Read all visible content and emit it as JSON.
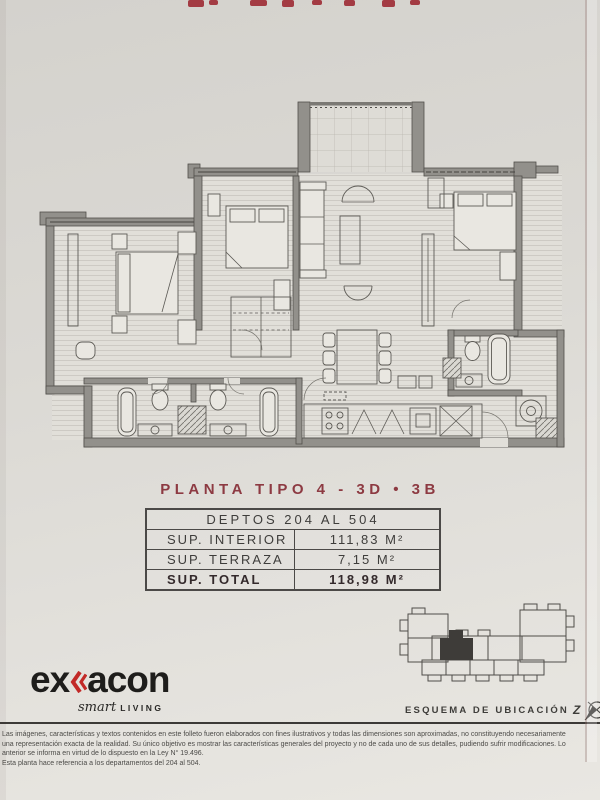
{
  "title": "PLANTA TIPO 4 - 3D • 3B",
  "table": {
    "header": "DEPTOS 204 AL 504",
    "rows": [
      {
        "label": "SUP. INTERIOR",
        "value": "111,83 M²"
      },
      {
        "label": "SUP. TERRAZA",
        "value": "7,15 M²"
      },
      {
        "label": "SUP. TOTAL",
        "value": "118,98 M²"
      }
    ]
  },
  "logo": {
    "text_before": "ex",
    "text_after": "acon",
    "tagline_script": "smart",
    "tagline_caps": "LIVING"
  },
  "location": {
    "label": "ESQUEMA DE UBICACIÓN",
    "compass_letter": "Z"
  },
  "legal": {
    "lines": [
      "Las imágenes, características y textos contenidos en este folleto fueron elaborados con fines ilustrativos y todas las dimensiones son aproximadas, no constituyendo necesariamente",
      "una representación exacta de la realidad. Su único objetivo es mostrar las características generales del proyecto y no de cada uno de sus detalles, pudiendo sufrir modificaciones. Lo",
      "anterior se informa en virtud de lo dispuesto en la Ley N° 19.496.",
      "Esta planta hace referencia a los departamentos del 204 al 504."
    ]
  },
  "icons": {
    "logo-chevron": "double-left-chevron",
    "compass": "north-arrow-compass"
  },
  "colors": {
    "accent_red": "#8D3A42",
    "logo_red": "#C22927",
    "wall_gray": "#92908B",
    "text_dark": "#3E3D3B"
  }
}
